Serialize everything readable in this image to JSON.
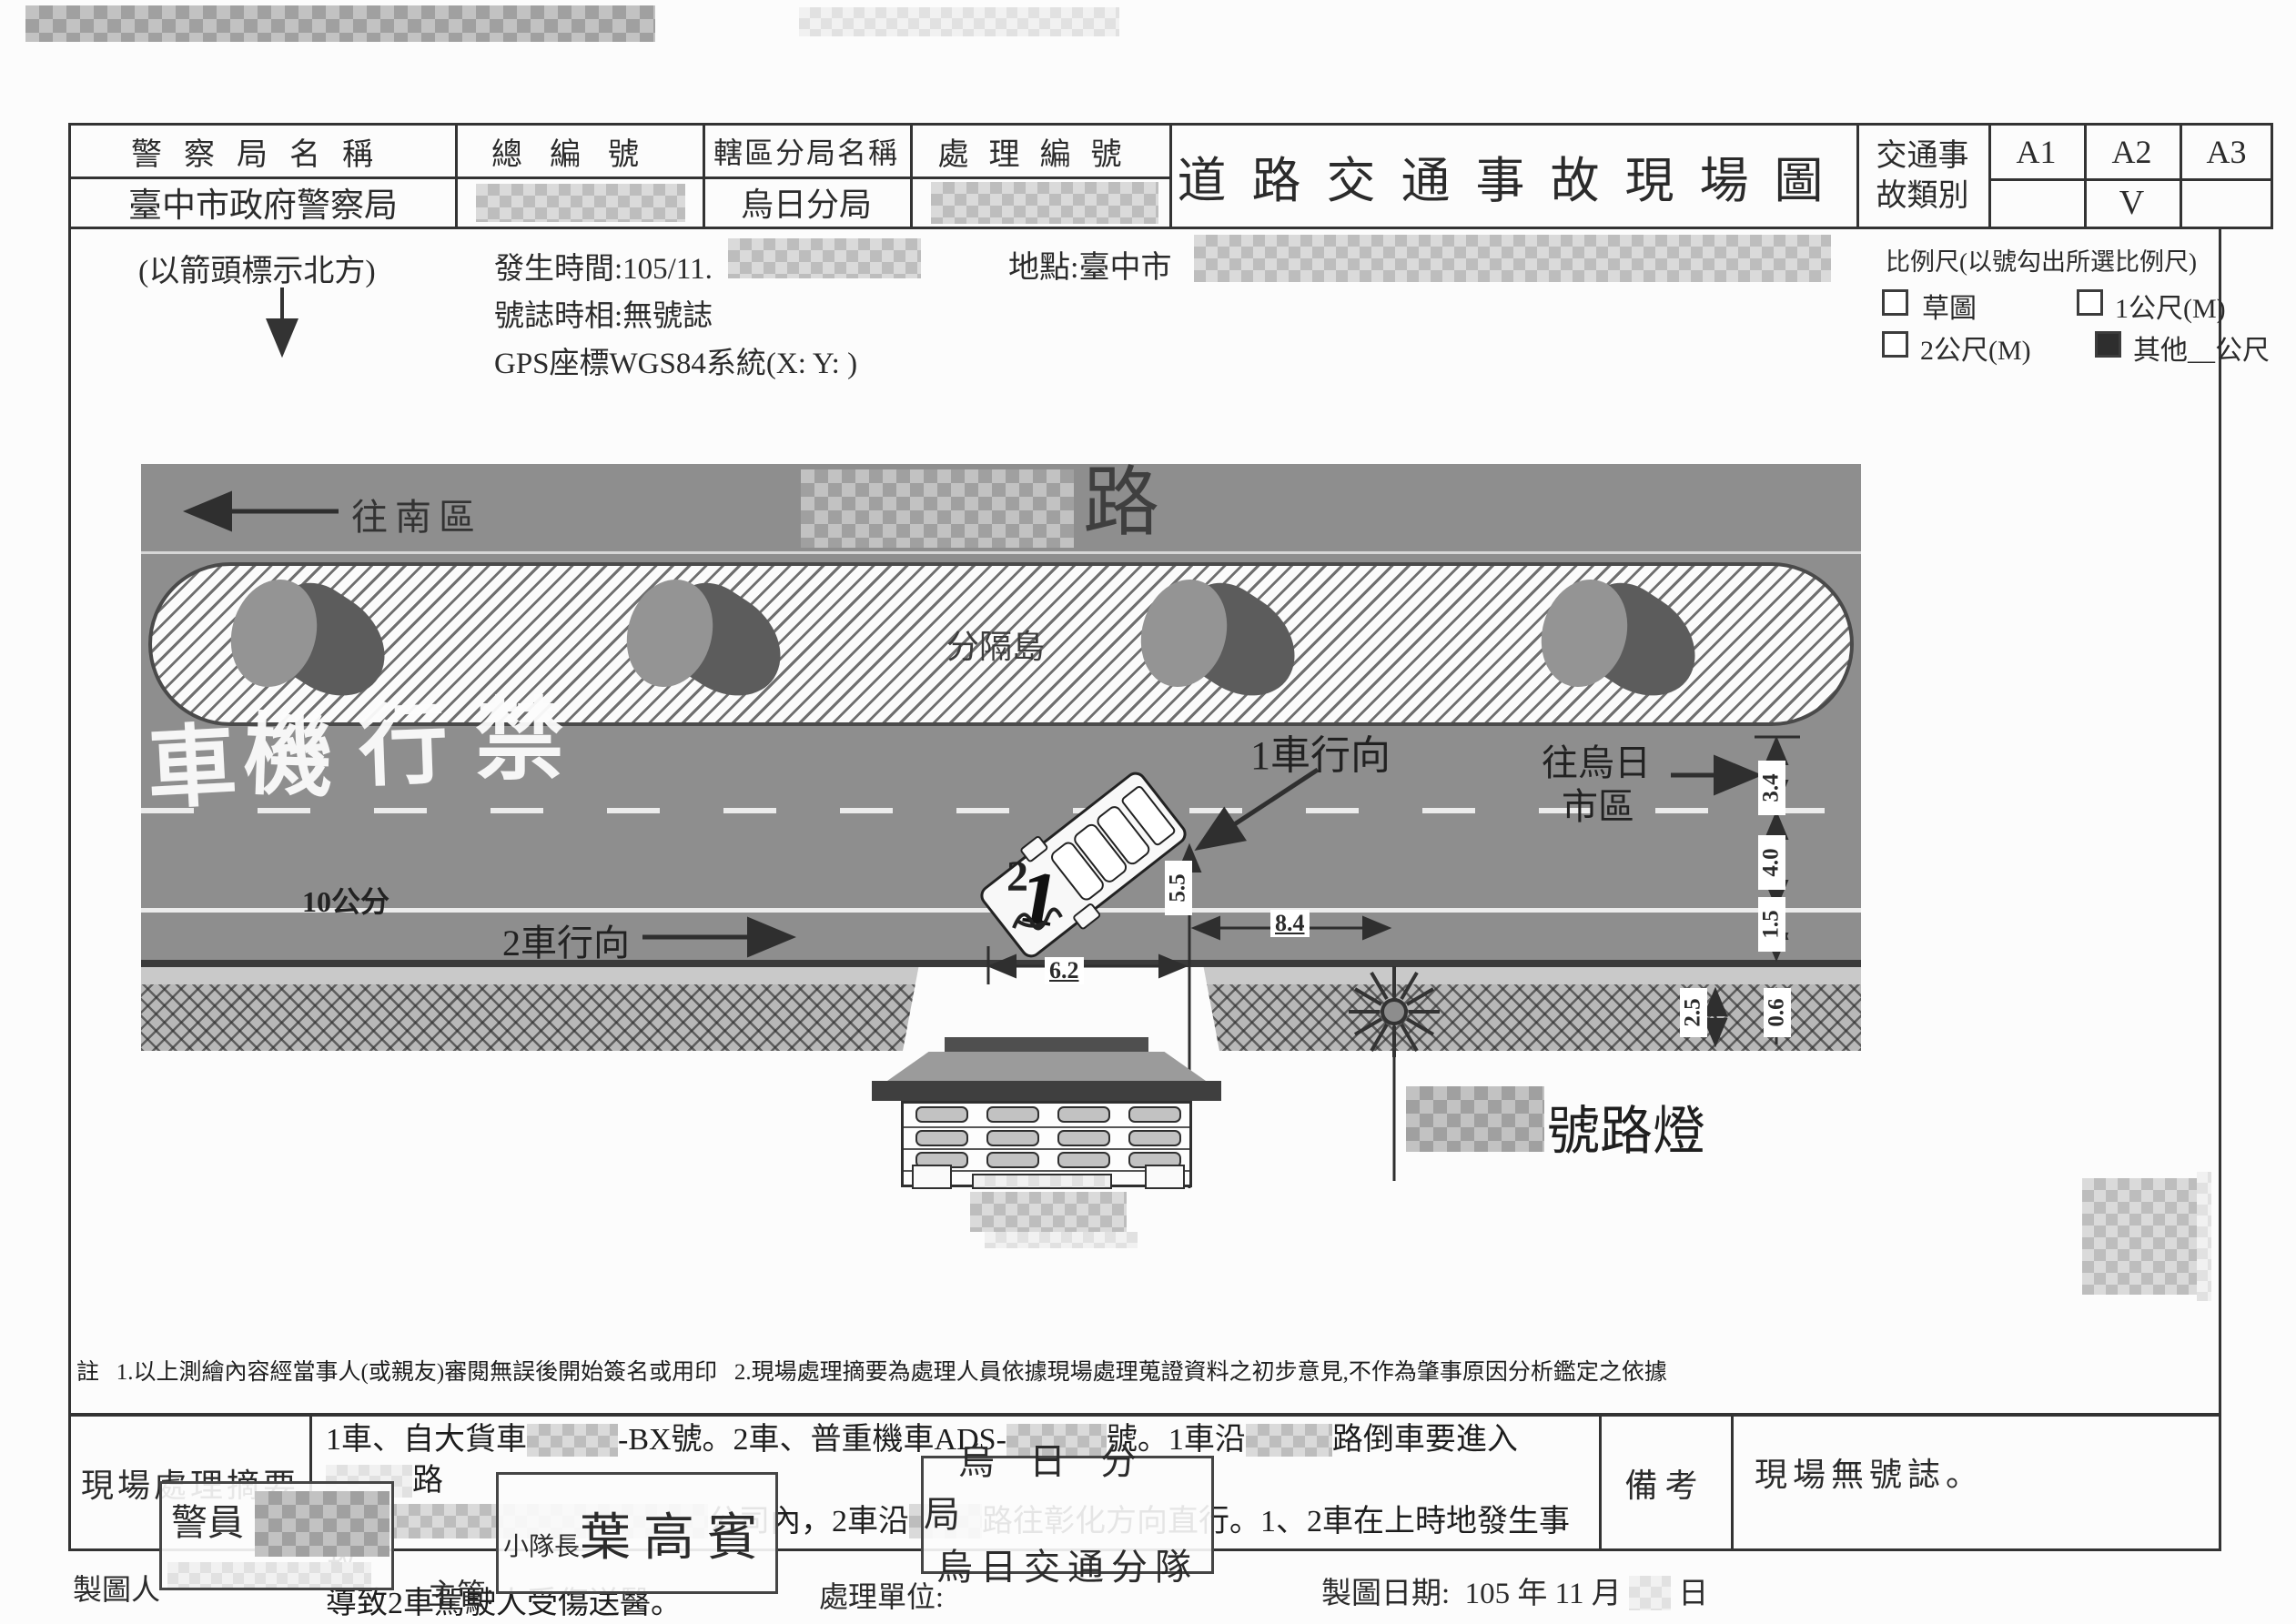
{
  "header": {
    "police_label": "警察局名稱",
    "police_value": "臺中市政府警察局",
    "serial_label": "總編號",
    "branch_label": "轄區分局名稱",
    "branch_value": "烏日分局",
    "case_label": "處理編號",
    "title": "道路交通事故現場圖",
    "category_line1": "交通事",
    "category_line2": "故類別",
    "a1": "A1",
    "a2": "A2",
    "a3": "A3",
    "a2_check": "V"
  },
  "info": {
    "north_note": "(以箭頭標示北方)",
    "time_label": "發生時間:105/11.",
    "signal_label": "號誌時相:無號誌",
    "gps_label": "GPS座標WGS84系統(X:  Y: )",
    "location_label": "地點:臺中市",
    "scale_title": "比例尺(以號勾出所選比例尺)",
    "scale_sketch": "草圖",
    "scale_1m": "1公尺(M)",
    "scale_2m": "2公尺(M)",
    "scale_other": "其他__公尺"
  },
  "diagram": {
    "to_south": "往南區",
    "road_suffix": "路",
    "median_label": "分隔島",
    "paint_chars": [
      "車",
      "機",
      "行",
      "禁"
    ],
    "ten_cm": "10公分",
    "veh2_dir": "2車行向",
    "veh1_dir": "1車行向",
    "to_wuri_line1": "往烏日",
    "to_wuri_line2": "市區",
    "lamp_suffix": "號路燈",
    "veh1_no": "1",
    "veh2_no": "2",
    "dims": {
      "d55": "5.5",
      "d62": "6.2",
      "d84": "8.4",
      "d34": "3.4",
      "d40": "4.0",
      "d15": "1.5",
      "d25": "2.5",
      "d06": "0.6"
    }
  },
  "note": {
    "prefix": "註",
    "item1": "1.以上測繪內容經當事人(或親友)審閱無誤後開始簽名或用印",
    "item2": "2.現場處理摘要為處理人員依據現場處理蒐證資料之初步意見,不作為肇事原因分析鑑定之依據"
  },
  "summary": {
    "label": "現場處理摘要",
    "l1a": "1車、自大貨車",
    "l1b": "-BX號。2車、普重機車ADS-",
    "l1c": "號。1車沿",
    "l1d": "路倒車要進入",
    "l1e": "路",
    "l2a": "公司內，2車沿",
    "l2b": "路往彰化方向直行。1、2車在上時地發生事故",
    "l3": "導致2車駕駛人受傷送醫。",
    "remark_label": "備考",
    "remark_value": "現場無號誌。"
  },
  "footer": {
    "drafter_label": "製圖人",
    "supervisor_label": "主管:",
    "unit_label": "處理單位:",
    "date_label": "製圖日期:",
    "date_part1": "105 年 11 月",
    "date_part2": "日",
    "stamp_officer": "警員",
    "stamp_rank": "小隊長",
    "stamp_name": "葉高賓",
    "stamp_unit_line1": "烏日分局",
    "stamp_unit_line2": "烏日交通分隊"
  }
}
